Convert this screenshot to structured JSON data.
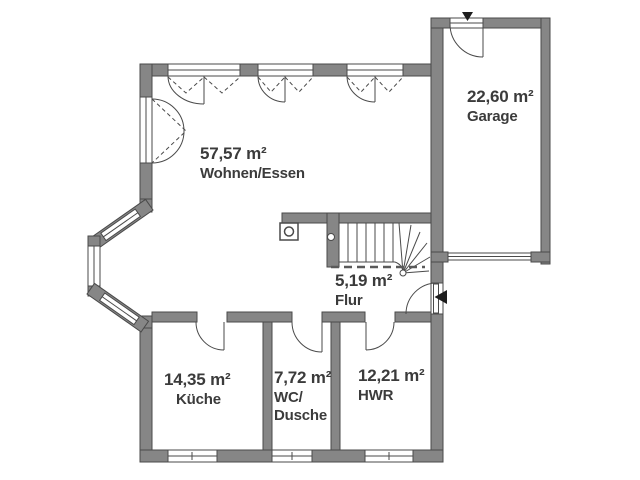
{
  "rooms": {
    "wohnen": {
      "area": "57,57 m²",
      "name": "Wohnen/Essen"
    },
    "garage": {
      "area": "22,60 m²",
      "name": "Garage"
    },
    "flur": {
      "area": "5,19 m²",
      "name": "Flur"
    },
    "kueche": {
      "area": "14,35 m²",
      "name": "Küche"
    },
    "wc": {
      "area": "7,72 m²",
      "name": "WC/",
      "name2": "Dusche"
    },
    "hwr": {
      "area": "12,21 m²",
      "name": "HWR"
    }
  },
  "colors": {
    "wall": "#868686",
    "line": "#4a4a4a",
    "text": "#3b3b3b",
    "background": "#ffffff"
  }
}
